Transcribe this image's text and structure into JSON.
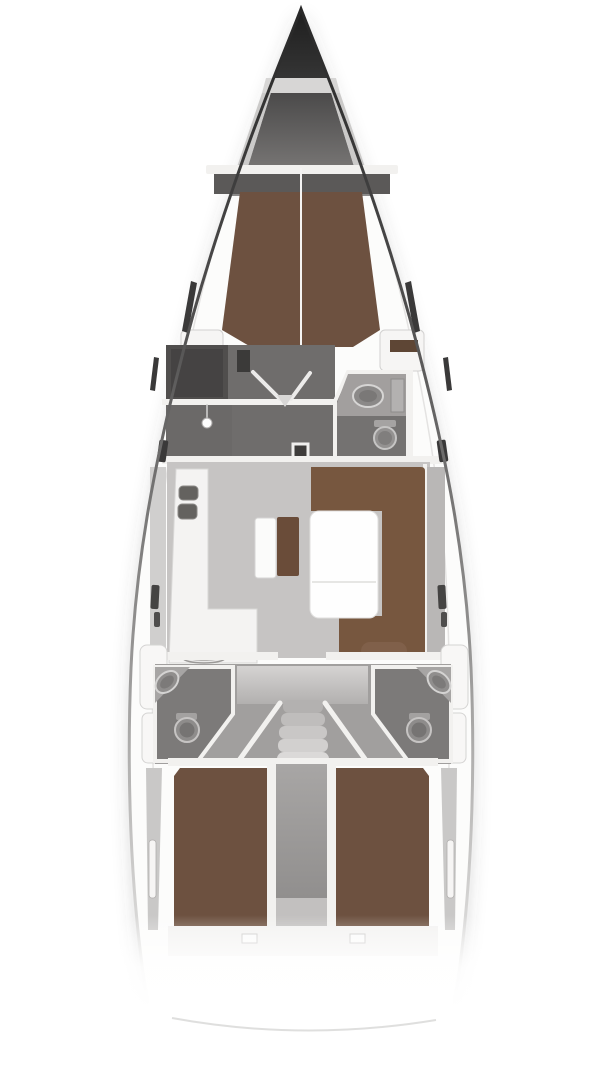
{
  "diagram": {
    "type": "yacht-interior-floor-plan",
    "orientation": "bow-up",
    "regions": [
      "bow-anchor-locker",
      "forward-cabin-v-berth",
      "port-forward-head",
      "dressing-area",
      "starboard-forward-head",
      "galley",
      "nav-seat",
      "salon-table",
      "salon-settee",
      "companionway-stairs",
      "port-aft-head",
      "starboard-aft-head",
      "port-aft-cabin-berth",
      "starboard-aft-cabin-berth",
      "engine-compartment",
      "stern-platform"
    ]
  },
  "palette": {
    "background": "#ffffff",
    "hull_edge_dark": "#2c2c2c",
    "deck_white": "#fafaf9",
    "wall_white": "#f2f1ef",
    "floor_salon": "#c6c4c3",
    "floor_cabin_dark": "#6f6d6c",
    "head_room_gray": "#7c7a79",
    "berth_brown": "#6d5140",
    "settee_brown": "#77573f",
    "cushion_brown": "#6a4c39",
    "cushion_light": "#80604a",
    "table_white": "#fefefe",
    "galley_white": "#f4f3f2",
    "sidewall_gray": "#b9b7b6",
    "window_dark": "#3a3939",
    "fixture_gray": "#8e8c8b",
    "aft_zone_gray": "#a19f9e",
    "engine_bay_gray": "#9a9897"
  }
}
